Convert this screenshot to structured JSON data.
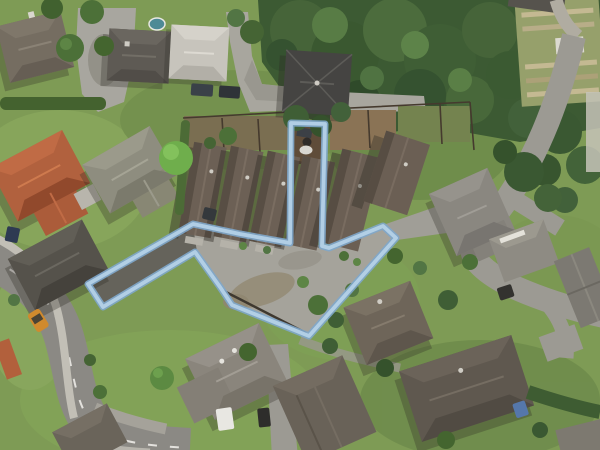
{
  "map": {
    "kind": "aerial-photo",
    "width": 600,
    "height": 450
  },
  "boundary": {
    "label": "property-parcel-boundary",
    "points": "88,284 193,224 240,234 290,243 291,123 325,124 322,246 329,248 383,226 396,238 309,336 232,305 220,287 195,252 103,307",
    "fill_color": "none",
    "line_color": "#b4d1e7",
    "edge_color": "#7fa7cb",
    "edge_hex": "#7fa7cb",
    "line_width": "3.8",
    "edge_width": "7"
  },
  "palette": {
    "lawn": "#7e9b55",
    "bush": "#3c5a33",
    "asphalt": "#8b8984",
    "concrete": "#a5a39b",
    "footpath": "#c2bfb6"
  }
}
